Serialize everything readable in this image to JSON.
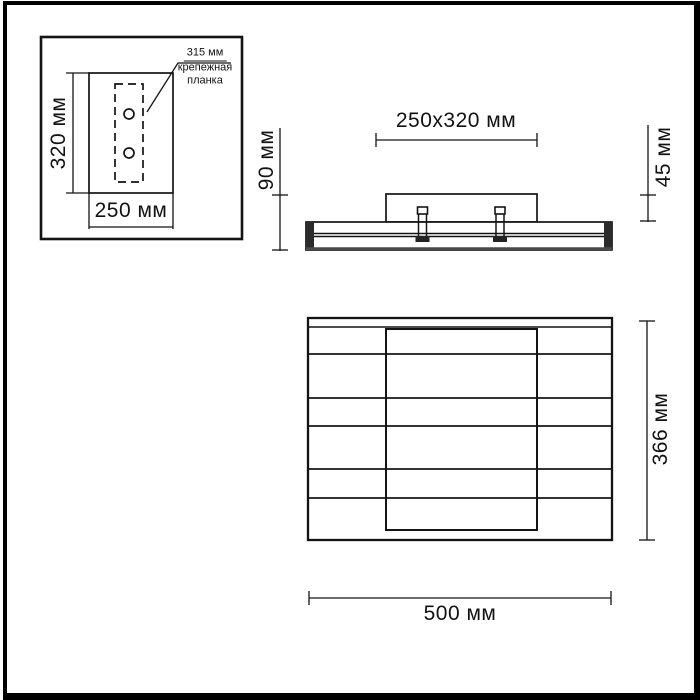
{
  "drawing_title": "light-fixture-dimension-drawing",
  "views": {
    "inset": {
      "height_label": "320 мм",
      "width_label": "250 мм",
      "note_line1": "315 мм",
      "note_line2": "крепежная",
      "note_line3": "планка"
    },
    "side": {
      "plate_dim_label": "250x320 мм",
      "total_height_label": "90 мм",
      "plate_height_label": "45 мм"
    },
    "front": {
      "height_label": "366 мм",
      "width_label": "500 мм"
    }
  },
  "colors": {
    "line": "#141414",
    "cap_fill": "#2b2b2b",
    "background": "#ffffff"
  }
}
